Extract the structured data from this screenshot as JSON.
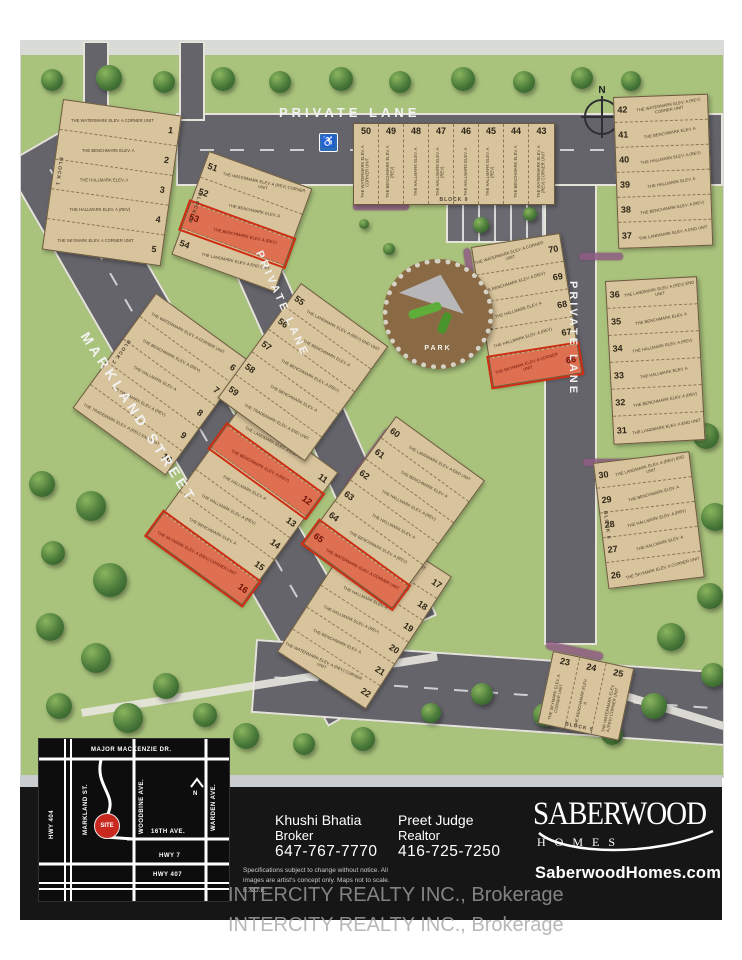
{
  "page": {
    "watermark": "INTERCITY REALTY INC., Brokerage"
  },
  "site": {
    "road_labels": {
      "markland": "MARKLAND STREET",
      "lane_top": "PRIVATE LANE",
      "lane_mid": "PRIVATE LANE",
      "lane_right": "PRIVATE LANE"
    },
    "park_label": "PARK",
    "north_label": "N",
    "handicap_icon": "wheelchair",
    "colors": {
      "grass_green": "#a9c37c",
      "road_gray": "#64646a",
      "building_tan": "#d8c49c",
      "highlight_red": "#cf2d12",
      "panel_black": "#161616",
      "site_marker_red": "#c8281e"
    },
    "blocks": [
      {
        "id": "b1",
        "label": "BLOCK 1",
        "lots": [
          {
            "num": "1",
            "model": "THE WATERMARK ELEV. A CORNER UNIT"
          },
          {
            "num": "2",
            "model": "THE BENCHMARK ELEV. A"
          },
          {
            "num": "3",
            "model": "THE HALLMARK ELEV. A"
          },
          {
            "num": "4",
            "model": "THE HALLMARK ELEV. A (REV)"
          },
          {
            "num": "5",
            "model": "THE SKYMARK ELEV. A CORNER UNIT"
          }
        ]
      },
      {
        "id": "b2",
        "label": "BLOCK 2",
        "lots": [
          {
            "num": "6",
            "model": "THE WATERMARK ELEV. A CORNER UNIT"
          },
          {
            "num": "7",
            "model": "THE BENCHMARK ELEV. A (REV)"
          },
          {
            "num": "8",
            "model": "THE HALLMARK ELEV. A"
          },
          {
            "num": "9",
            "model": "THE HALLMARK ELEV. A (REV)"
          },
          {
            "num": "10",
            "model": "THE TRADEMARK ELEV. A (REV) END UNIT"
          }
        ]
      },
      {
        "id": "b3",
        "label": "",
        "lots": [
          {
            "num": "11",
            "model": "THE LANDMARK ELEV. A END UNIT"
          },
          {
            "num": "12",
            "model": "THE BENCHMARK ELEV. A (REV)",
            "highlighted": true
          },
          {
            "num": "13",
            "model": "THE HALLMARK ELEV. A"
          },
          {
            "num": "14",
            "model": "THE HALLMARK ELEV. A (REV)"
          },
          {
            "num": "15",
            "model": "THE BENCHMARK ELEV. A"
          },
          {
            "num": "16",
            "model": "THE SKYMARK ELEV. A (REV) CORNER UNIT",
            "highlighted": true
          }
        ]
      },
      {
        "id": "b4",
        "label": "",
        "lots": [
          {
            "num": "17",
            "model": "THE LANDMARK ELEV. A END UNIT"
          },
          {
            "num": "18",
            "model": "THE BENCHMARK ELEV. A (REV)"
          },
          {
            "num": "19",
            "model": "THE HALLMARK ELEV. A"
          },
          {
            "num": "20",
            "model": "THE HALLMARK ELEV. A (REV)"
          },
          {
            "num": "21",
            "model": "THE BENCHMARK ELEV. A"
          },
          {
            "num": "22",
            "model": "THE WATERMARK ELEV. A (REV) CORNER UNIT"
          }
        ]
      },
      {
        "id": "b5",
        "label": "BLOCK 5",
        "lots": [
          {
            "num": "23",
            "model": "THE SKYMARK ELEV. A CORNER UNIT"
          },
          {
            "num": "24",
            "model": "THE BENCHMARK ELEV. A"
          },
          {
            "num": "25",
            "model": "THE WATERMARK ELEV. A (REV) CORNER UNIT"
          }
        ]
      },
      {
        "id": "b6",
        "label": "BLOCK 6",
        "lots": [
          {
            "num": "30",
            "model": "THE LANDMARK ELEV. A (REV) END UNIT"
          },
          {
            "num": "29",
            "model": "THE BENCHMARK ELEV. A"
          },
          {
            "num": "28",
            "model": "THE HALLMARK ELEV. A (REV)"
          },
          {
            "num": "27",
            "model": "THE HALLMARK ELEV. A"
          },
          {
            "num": "26",
            "model": "THE SKYMARK ELEV. A CORNER UNIT"
          }
        ]
      },
      {
        "id": "b7",
        "label": "",
        "lots": [
          {
            "num": "36",
            "model": "THE LANDMARK ELEV. A (REV) END UNIT"
          },
          {
            "num": "35",
            "model": "THE BENCHMARK ELEV. A"
          },
          {
            "num": "34",
            "model": "THE HALLMARK ELEV. A (REV)"
          },
          {
            "num": "33",
            "model": "THE HALLMARK ELEV. A"
          },
          {
            "num": "32",
            "model": "THE BENCHMARK ELEV. A (REV)"
          },
          {
            "num": "31",
            "model": "THE LANDMARK ELEV. A END UNIT"
          }
        ]
      },
      {
        "id": "b8",
        "label": "",
        "lots": [
          {
            "num": "42",
            "model": "THE WATERMARK ELEV. A (REV) CORNER UNIT"
          },
          {
            "num": "41",
            "model": "THE BENCHMARK ELEV. A"
          },
          {
            "num": "40",
            "model": "THE HALLMARK ELEV. A (REV)"
          },
          {
            "num": "39",
            "model": "THE HALLMARK ELEV. A"
          },
          {
            "num": "38",
            "model": "THE BENCHMARK ELEV. A (REV)"
          },
          {
            "num": "37",
            "model": "THE LANDMARK ELEV. A END UNIT"
          }
        ]
      },
      {
        "id": "b9",
        "label": "BLOCK 9",
        "lots": [
          {
            "num": "50",
            "model": "THE WATERMARK ELEV. A CORNER UNIT"
          },
          {
            "num": "49",
            "model": "THE BENCHMARK ELEV. A (REV)"
          },
          {
            "num": "48",
            "model": "THE HALLMARK ELEV. A"
          },
          {
            "num": "47",
            "model": "THE HALLMARK ELEV. A (REV)"
          },
          {
            "num": "46",
            "model": "THE HALLMARK ELEV. A"
          },
          {
            "num": "45",
            "model": "THE HALLMARK ELEV. A (REV)"
          },
          {
            "num": "44",
            "model": "THE BENCHMARK ELEV. A"
          },
          {
            "num": "43",
            "model": "THE WATERMARK ELEV. A (REV) CORNER UNIT"
          }
        ]
      },
      {
        "id": "b10",
        "label": "BLOCK 10",
        "lots": [
          {
            "num": "51",
            "model": "THE WATERMARK ELEV. A (REV) CORNER UNIT"
          },
          {
            "num": "52",
            "model": "THE BENCHMARK ELEV. A"
          },
          {
            "num": "53",
            "model": "THE BENCHMARK ELEV. A (REV)",
            "highlighted": true
          },
          {
            "num": "54",
            "model": "THE LANDMARK ELEV. A END UNIT"
          }
        ]
      },
      {
        "id": "b11",
        "label": "",
        "lots": [
          {
            "num": "55",
            "model": "THE LANDMARK ELEV. A (REV) END UNIT"
          },
          {
            "num": "56",
            "model": "THE BENCHMARK ELEV. A"
          },
          {
            "num": "57",
            "model": "THE BENCHMARK ELEV. A (REV)"
          },
          {
            "num": "58",
            "model": "THE BENCHMARK ELEV. A"
          },
          {
            "num": "59",
            "model": "THE TRADEMARK ELEV. A END UNIT"
          }
        ]
      },
      {
        "id": "b12",
        "label": "",
        "lots": [
          {
            "num": "60",
            "model": "THE LANDMARK ELEV. A END UNIT"
          },
          {
            "num": "61",
            "model": "THE BENCHMARK ELEV. A"
          },
          {
            "num": "62",
            "model": "THE HALLMARK ELEV. A (REV)"
          },
          {
            "num": "63",
            "model": "THE HALLMARK ELEV. A"
          },
          {
            "num": "64",
            "model": "THE BENCHMARK ELEV. A (REV)"
          },
          {
            "num": "65",
            "model": "THE WATERMARK ELEV. A CORNER UNIT",
            "highlighted": true
          }
        ]
      },
      {
        "id": "b13",
        "label": "BLOCK 12",
        "lots": [
          {
            "num": "70",
            "model": "THE WATERMARK ELEV. A CORNER UNIT"
          },
          {
            "num": "69",
            "model": "THE BENCHMARK ELEV. A (REV)"
          },
          {
            "num": "68",
            "model": "THE HALLMARK ELEV. A"
          },
          {
            "num": "67",
            "model": "THE HALLMARK ELEV. A (REV)"
          },
          {
            "num": "66",
            "model": "THE SKYMARK ELEV. A CORNER UNIT",
            "highlighted": true
          }
        ]
      }
    ]
  },
  "footer": {
    "inset_map": {
      "vertical_roads": [
        "HWY 404",
        "MARKLAND ST.",
        "WOODBINE AVE.",
        "WARDEN AVE."
      ],
      "horizontal_roads": [
        "MAJOR MACKENZIE DR.",
        "16TH AVE.",
        "HWY 7",
        "HWY 407"
      ],
      "site_marker": "SITE",
      "north": "N"
    },
    "agents": [
      {
        "name": "Khushi Bhatia",
        "title": "Broker",
        "phone": "647-767-7770"
      },
      {
        "name": "Preet Judge",
        "title": "Realtor",
        "phone": "416-725-7250"
      }
    ],
    "disclaimer": "Specifications subject to change without notice. All images are artist's concept only. Maps not to scale. E.&O.E.",
    "brand": {
      "name": "SABERWOOD",
      "sub": "HOMES",
      "website": "SaberwoodHomes.com"
    }
  }
}
